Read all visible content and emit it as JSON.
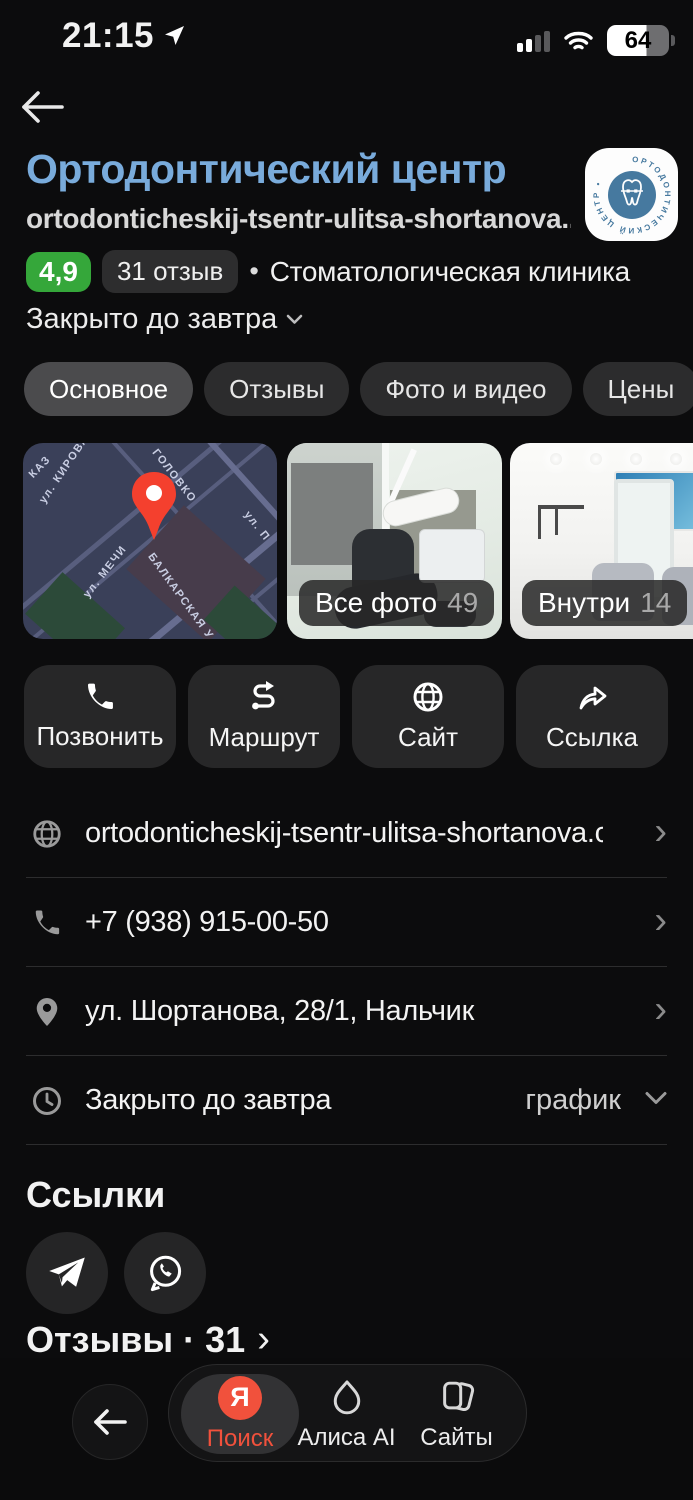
{
  "status_bar": {
    "time": "21:15",
    "battery_percent": "64"
  },
  "header": {
    "title": "Ортодонтический центр",
    "subtitle": "ortodonticheskij-tsentr-ulitsa-shortanova....",
    "rating": "4,9",
    "reviews_pill": "31 отзыв",
    "category": "Стоматологическая клиника",
    "open_status": "Закрыто до завтра",
    "logo_circular_text": "ОРТОДОНТИЧЕСКИЙ ЦЕНТР •"
  },
  "icons": {
    "dot": "•",
    "chevron_right": "›"
  },
  "tabs": [
    {
      "label": "Основное"
    },
    {
      "label": "Отзывы"
    },
    {
      "label": "Фото и видео"
    },
    {
      "label": "Цены"
    },
    {
      "label": "Новости"
    }
  ],
  "photos": {
    "map_labels": [
      "КАЗ",
      "ул. КИРОВА",
      "ГОЛОВКО",
      "ул. МЕЧИ",
      "БАЛКАРСКАЯ У",
      "ул. П"
    ],
    "all_photos_label": "Все фото",
    "all_photos_count": "49",
    "inside_label": "Внутри",
    "inside_count": "14"
  },
  "actions": [
    {
      "label": "Позвонить"
    },
    {
      "label": "Маршрут"
    },
    {
      "label": "Сайт"
    },
    {
      "label": "Ссылка"
    }
  ],
  "info_rows": {
    "website": "ortodonticheskij-tsentr-ulitsa-shortanova.clie...",
    "phone": "+7 (938) 915-00-50",
    "address": "ул. Шортанова, 28/1, Нальчик",
    "schedule_status": "Закрыто до завтра",
    "schedule_link": "график"
  },
  "links_section": {
    "title": "Ссылки"
  },
  "reviews_heading": {
    "label": "Отзывы · 31"
  },
  "bottom_nav": {
    "search_logo": "Я",
    "search_label": "Поиск",
    "alice_label": "Алиса AI",
    "sites_label": "Сайты"
  },
  "colors": {
    "accent_blue": "#79abdb",
    "rating_green": "#35a73a",
    "yandex_red": "#f1513c",
    "map_pin_red": "#f4402e",
    "background": "#0c0c0d"
  }
}
